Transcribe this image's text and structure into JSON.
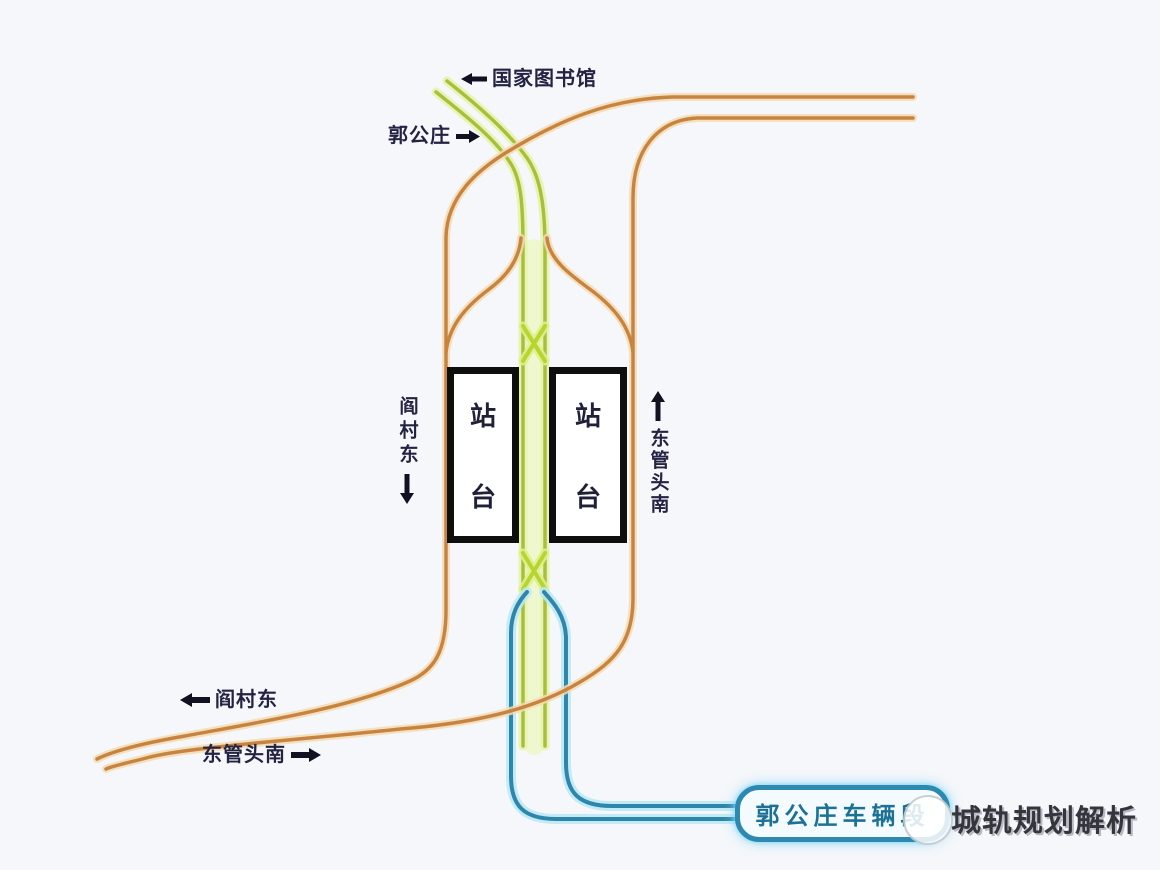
{
  "diagram": {
    "title": "郭公庄站 轨道配线示意图",
    "background": "#f5f7fa",
    "colors": {
      "line9_green": "#a8bf3c",
      "line9_glow": "#e9f3b0",
      "line9_band_glow": "#eef6c4",
      "crossover_green": "#b7d52f",
      "crossover_glow": "#dcef8e",
      "fangshan_orange": "#c78440",
      "fangshan_glow": "#f4ddb4",
      "depot_blue": "#2d86ab",
      "depot_glow": "#bce9f5",
      "platform_border": "#0e0e0e",
      "label_text": "#232343",
      "depot_text": "#1c7296",
      "watermark_text": "#35353d"
    },
    "labels": {
      "national_library": "国家图书馆",
      "guogongzhuang": "郭公庄",
      "yancun_east_side": "阎村东",
      "dongguantou_south_side": "东管头南",
      "yancun_east_bottom": "阎村东",
      "dongguantou_south_bottom": "东管头南"
    },
    "platforms": {
      "top_char": "站",
      "bottom_char": "台"
    },
    "depot": {
      "name": "郭公庄车辆段"
    },
    "watermark": {
      "text": "城轨规划解析"
    }
  }
}
